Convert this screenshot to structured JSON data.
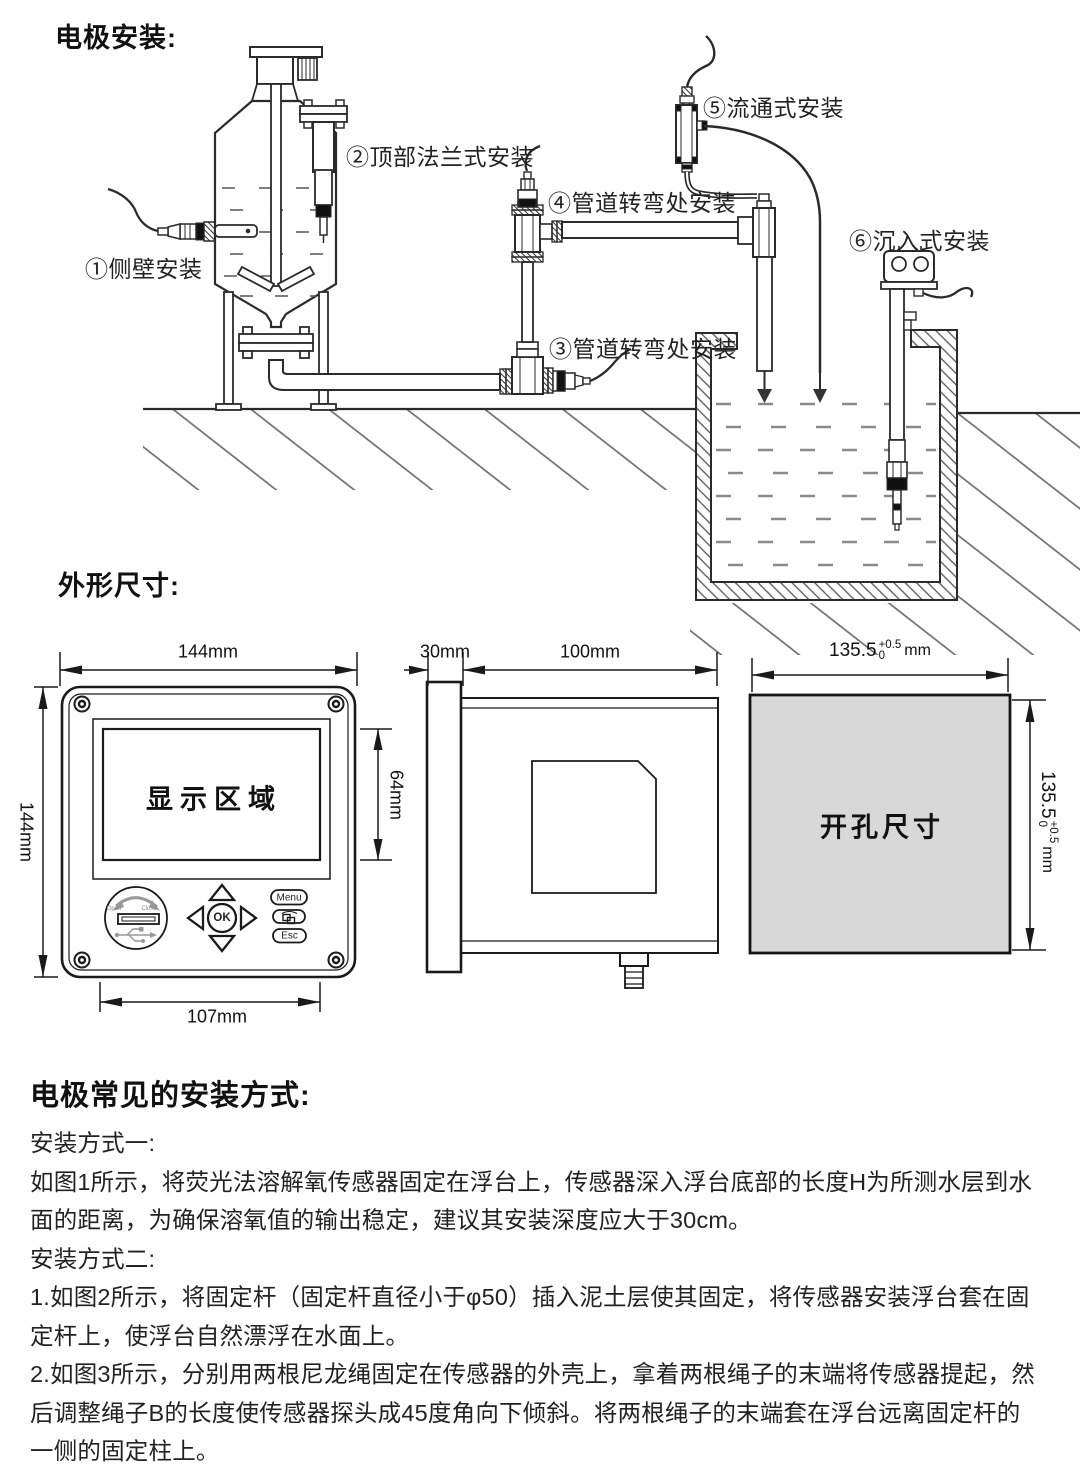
{
  "titles": {
    "install": "电极安装:",
    "dimensions": "外形尺寸:"
  },
  "install_labels": {
    "l1": "①侧壁安装",
    "l2": "②顶部法兰式安装",
    "l3": "③管道转弯处安装",
    "l4": "④管道转弯处安装",
    "l5": "⑤流通式安装",
    "l6": "⑥沉入式安装"
  },
  "front_view": {
    "width": "144mm",
    "height": "144mm",
    "display_height": "64mm",
    "keypad_width": "107mm",
    "display_label": "显示区域",
    "keys": {
      "open": "Open",
      "close": "Close",
      "ok": "OK",
      "menu": "Menu",
      "esc": "Esc"
    }
  },
  "side_view": {
    "bezel": "30mm",
    "depth": "100mm"
  },
  "cutout": {
    "label": "开孔尺寸",
    "dim_value": "135.5",
    "dim_plus": "+0.5",
    "dim_minus": "0",
    "dim_unit": "mm"
  },
  "instructions": {
    "heading": "电极常见的安装方式:",
    "p1": "安装方式一:",
    "p2": "如图1所示，将荧光法溶解氧传感器固定在浮台上，传感器深入浮台底部的长度H为所测水层到水面的距离，为确保溶氧值的输出稳定，建议其安装深度应大于30cm。",
    "p3": "安装方式二:",
    "p4": "1.如图2所示，将固定杆（固定杆直径小于φ50）插入泥土层使其固定，将传感器安装浮台套在固定杆上，使浮台自然漂浮在水面上。",
    "p5": "2.如图3所示，分别用两根尼龙绳固定在传感器的外壳上，拿着两根绳子的末端将传感器提起，然后调整绳子B的长度使传感器探头成45度角向下倾斜。将两根绳子的末端套在浮台远离固定杆的一侧的固定柱上。"
  },
  "colors": {
    "line": "#2a2a2a",
    "gray_fill": "#d8d8d8",
    "water": "#8a8a8a"
  }
}
